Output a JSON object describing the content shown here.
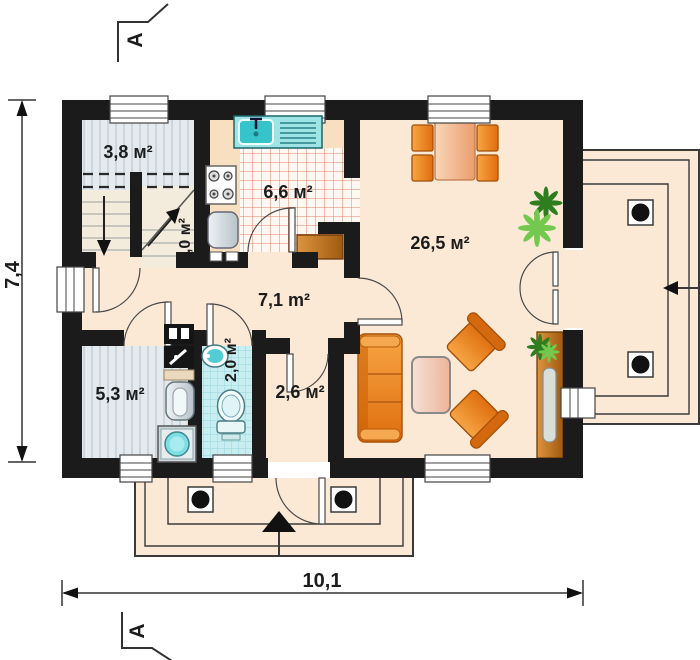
{
  "rooms": {
    "staircase": {
      "label": "3,8 м²",
      "name": "staircase room"
    },
    "stairs_flight": {
      "label": "3,0 м²",
      "name": "stair flight"
    },
    "kitchen": {
      "label": "6,6 м²",
      "name": "kitchen"
    },
    "living": {
      "label": "26,5 м²",
      "name": "living room"
    },
    "hall": {
      "label": "7,1 m²",
      "name": "hall"
    },
    "utility": {
      "label": "5,3 м²",
      "name": "utility room"
    },
    "bathroom": {
      "label": "2,0 м²",
      "name": "bathroom"
    },
    "corridor": {
      "label": "2,6 м²",
      "name": "corridor"
    }
  },
  "dimensions": {
    "width": "10,1",
    "height": "7,4"
  },
  "sections": {
    "top": "A",
    "bottom": "A"
  },
  "colors": {
    "wall": "#1b1b1b",
    "floor": "#fbe9d6",
    "kitchen_counter": "#f8dfc0",
    "kitchen_tile_line": "#e08266",
    "bathroom_tile": "#c9eef1",
    "stairs_floor": "#e4eaee",
    "furniture_orange": "#e8781c",
    "table_salmon": "#f2bd96",
    "wood_brown": "#c07022",
    "plant_green": "#5cb83a",
    "fixture_teal": "#57cfd6",
    "line": "#3a3a3a"
  }
}
